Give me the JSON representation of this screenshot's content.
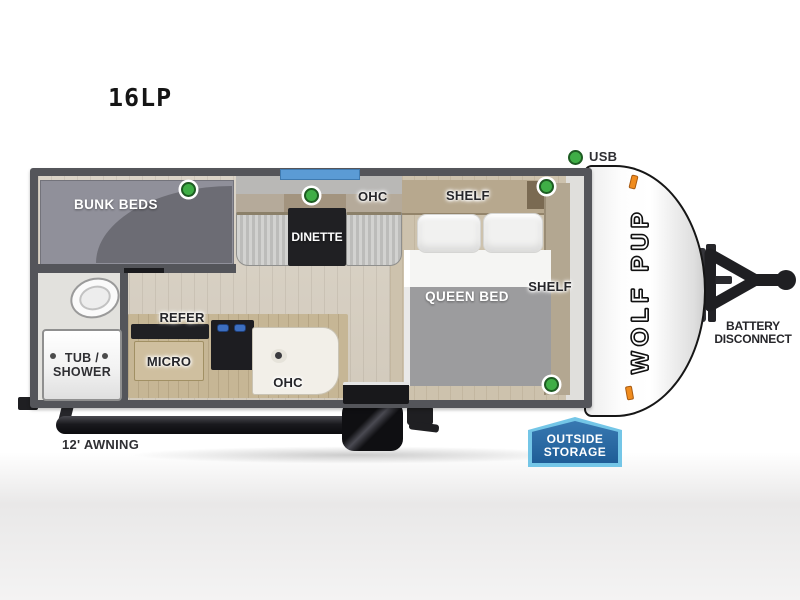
{
  "model": {
    "name": "16LP"
  },
  "brand": {
    "logo_text": "WOLF PUP"
  },
  "legend": {
    "usb": "USB"
  },
  "floorplan": {
    "bunk_beds": "BUNK BEDS",
    "dinette": {
      "label": "DINETTE",
      "ohc": "OHC"
    },
    "bedroom": {
      "queen_bed": "QUEEN BED",
      "shelf_front": "SHELF",
      "shelf_side": "SHELF"
    },
    "kitchen": {
      "refer": "REFER",
      "micro": "MICRO",
      "ohc": "OHC"
    },
    "bath": {
      "tub_line1": "TUB /",
      "tub_line2": "SHOWER"
    }
  },
  "exterior": {
    "awning": "12' AWNING",
    "outside_storage": {
      "line1": "OUTSIDE",
      "line2": "STORAGE"
    },
    "battery": {
      "line1": "BATTERY",
      "line2": "DISCONNECT"
    }
  },
  "colors": {
    "usb_dot": "#3fae46",
    "window_glass": "#5b9bd5",
    "storage_badge_fill": "#2b6aa3",
    "storage_badge_border": "#74c6e7",
    "marker_light": "#f08c1e"
  }
}
